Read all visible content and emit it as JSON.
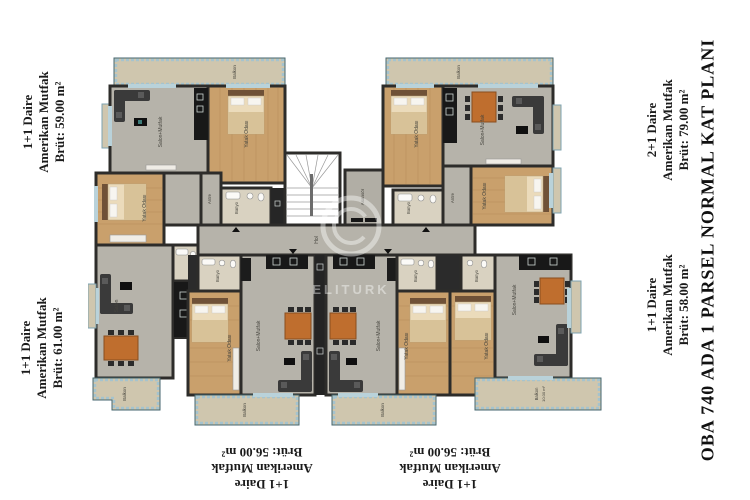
{
  "title": "OBA 740 ADA 1 PARSEL NORMAL KAT PLANI",
  "labels": {
    "top_left": {
      "unit": "1+1 Daire",
      "kitchen": "Amerikan Mutfak",
      "area": "Brüt: 59.00 m²"
    },
    "mid_left": {
      "unit": "1+1 Daire",
      "kitchen": "Amerikan Mutfak",
      "area": "Brüt: 61.00 m²"
    },
    "bottom_left": {
      "unit": "1+1 Daire",
      "kitchen": "Amerikan Mutfak",
      "area": "Brüt: 56.00 m²"
    },
    "bottom_right": {
      "unit": "1+1 Daire",
      "kitchen": "Amerikan Mutfak",
      "area": "Brüt: 56.00 m²"
    },
    "top_right": {
      "unit": "2+1 Daire",
      "kitchen": "Amerikan Mutfak",
      "area": "Brüt: 79.00 m²"
    },
    "mid_right": {
      "unit": "1+1 Daire",
      "kitchen": "Amerikan Mutfak",
      "area": "Brüt: 58.00 m²"
    }
  },
  "rooms": {
    "salon_mutfak": "Salon+Mutfak",
    "salon": "Salon",
    "bedroom": "Yatak Odası",
    "bathroom": "Banyo",
    "entry": "Antre",
    "balcony": "Balkon",
    "balcony_area": "10.00 m²",
    "hall": "Hol",
    "elevator": "Asansör"
  },
  "watermark": "ELITURK",
  "colors": {
    "wall": "#2d2c2a",
    "floor_gray": "#b6b3aa",
    "floor_wood": "#c9a06c",
    "balcony_floor": "#cfc6ae",
    "balcony_edge": "#9fbcc9",
    "bathroom_tile": "#d9d2c1",
    "table": "#bf6e2e",
    "sofa": "#3a3a3a",
    "window": "#b9d2da"
  }
}
